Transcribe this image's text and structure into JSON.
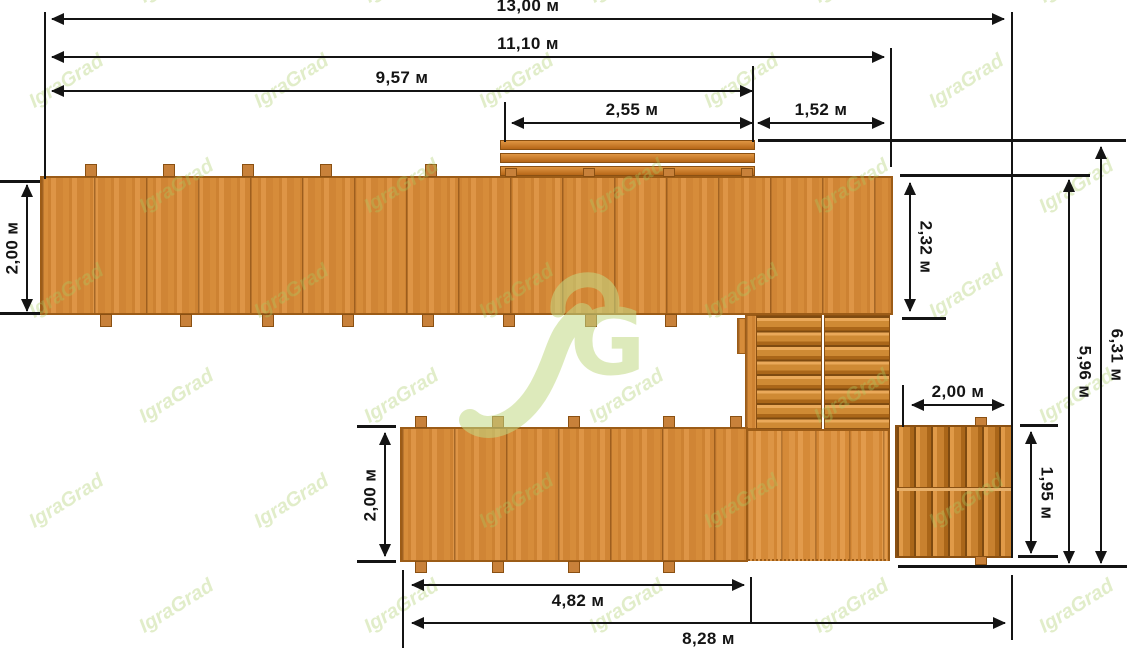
{
  "watermark": {
    "text": "IgraGrad",
    "color": "#a9cc63"
  },
  "logo": {
    "letter": "G",
    "color": "#c3d985"
  },
  "colors": {
    "wood": "#d28736",
    "wood_border": "#9c5c17",
    "dimension_line": "#141414",
    "background": "#ffffff"
  },
  "dimensions": {
    "total_width": "13,00 м",
    "upper_width": "11,10 м",
    "upper_walkway_length": "9,57 м",
    "bench_length": "2,55 м",
    "gap_width": "1,52 м",
    "upper_walkway_width": "2,00 м",
    "platform_depth": "2,32 м",
    "total_depth": "6,31 м",
    "deck_depth": "5,96 м",
    "lower_stairs_width": "2,00 м",
    "lower_stairs_depth": "1,95 м",
    "lower_walkway_width": "2,00 м",
    "lower_walkway_length": "4,82 м",
    "bottom_width": "8,28 м"
  }
}
